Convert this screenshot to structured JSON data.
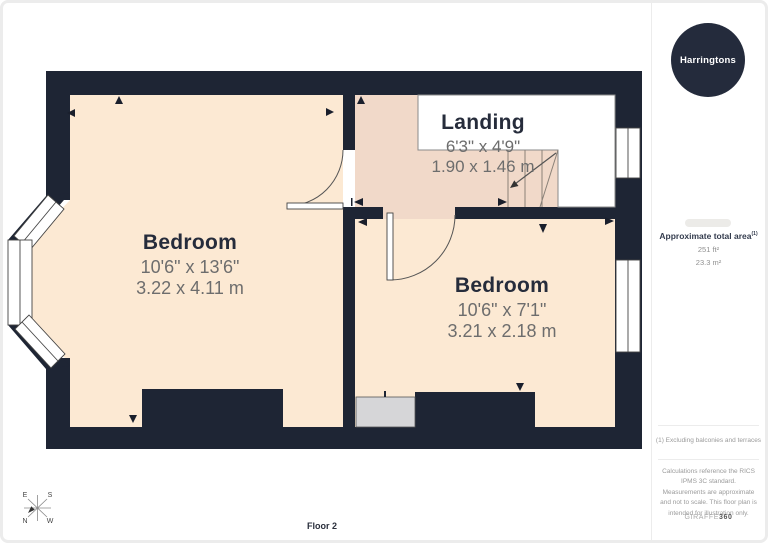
{
  "meta": {
    "floor_label": "Floor 2"
  },
  "branding": {
    "logo_text": "Harringtons"
  },
  "rooms": [
    {
      "name": "Bedroom",
      "dims_imperial": "10'6\" x 13'6\"",
      "dims_metric": "3.22 x 4.11 m"
    },
    {
      "name": "Bedroom",
      "dims_imperial": "10'6\" x 7'1\"",
      "dims_metric": "3.21 x 2.18 m"
    },
    {
      "name": "Landing",
      "dims_imperial": "6'3\" x 4'9\"",
      "dims_metric": "1.90 x 1.46 m"
    }
  ],
  "sidebar": {
    "area_title": "Approximate total area",
    "area_sup": "(1)",
    "area_ft": "251 ft²",
    "area_m": "23.3 m²",
    "footnote": "(1) Excluding balconies and terraces",
    "disclaimer": "Calculations reference the RICS IPMS 3C standard. Measurements are approximate and not to scale. This floor plan is intended for illustration only.",
    "brand": "GIRAFFE",
    "brand_bold": "360"
  },
  "compass": {
    "n": "N",
    "e": "E",
    "s": "S",
    "w": "W"
  },
  "colors": {
    "wall": "#1e2534",
    "bedroom_floor": "#fce9d3",
    "landing_floor": "#f1d9c9",
    "void": "#ffffff",
    "closet": "#d6d6d8",
    "ink": "#262c3b",
    "dim": "#6d6d6d",
    "muted": "#9b9b9b",
    "logo_bg": "#242b3c",
    "frame": "#ececec"
  }
}
